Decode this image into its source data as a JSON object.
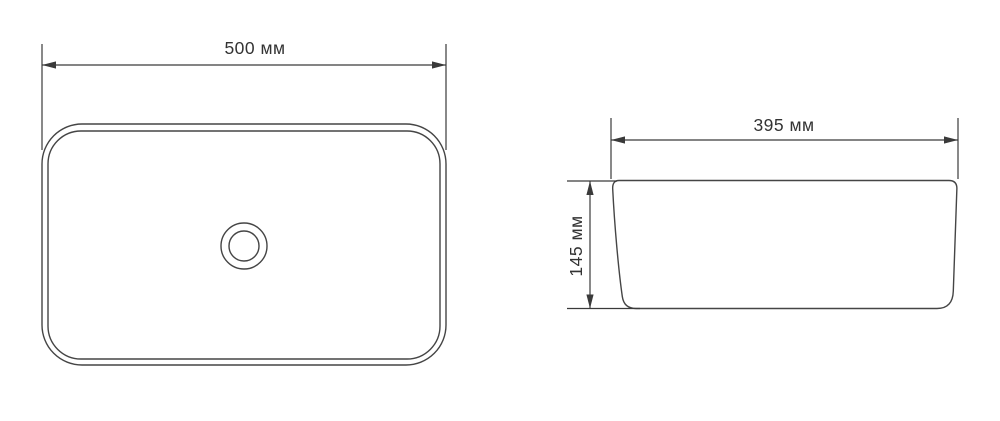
{
  "page": {
    "background": "#ffffff"
  },
  "drawing": {
    "line_color": "#454545",
    "dimension_line_color": "#3a3a3a",
    "text_color": "#333333",
    "top_view": {
      "width_dimension": {
        "label": "500 мм",
        "value_mm": 500,
        "unit": "мм",
        "orientation": "horizontal"
      }
    },
    "side_view": {
      "width_dimension": {
        "label": "395 мм",
        "value_mm": 395,
        "unit": "мм",
        "orientation": "horizontal"
      },
      "height_dimension": {
        "label": "145 мм",
        "value_mm": 145,
        "unit": "мм",
        "orientation": "vertical"
      }
    }
  }
}
